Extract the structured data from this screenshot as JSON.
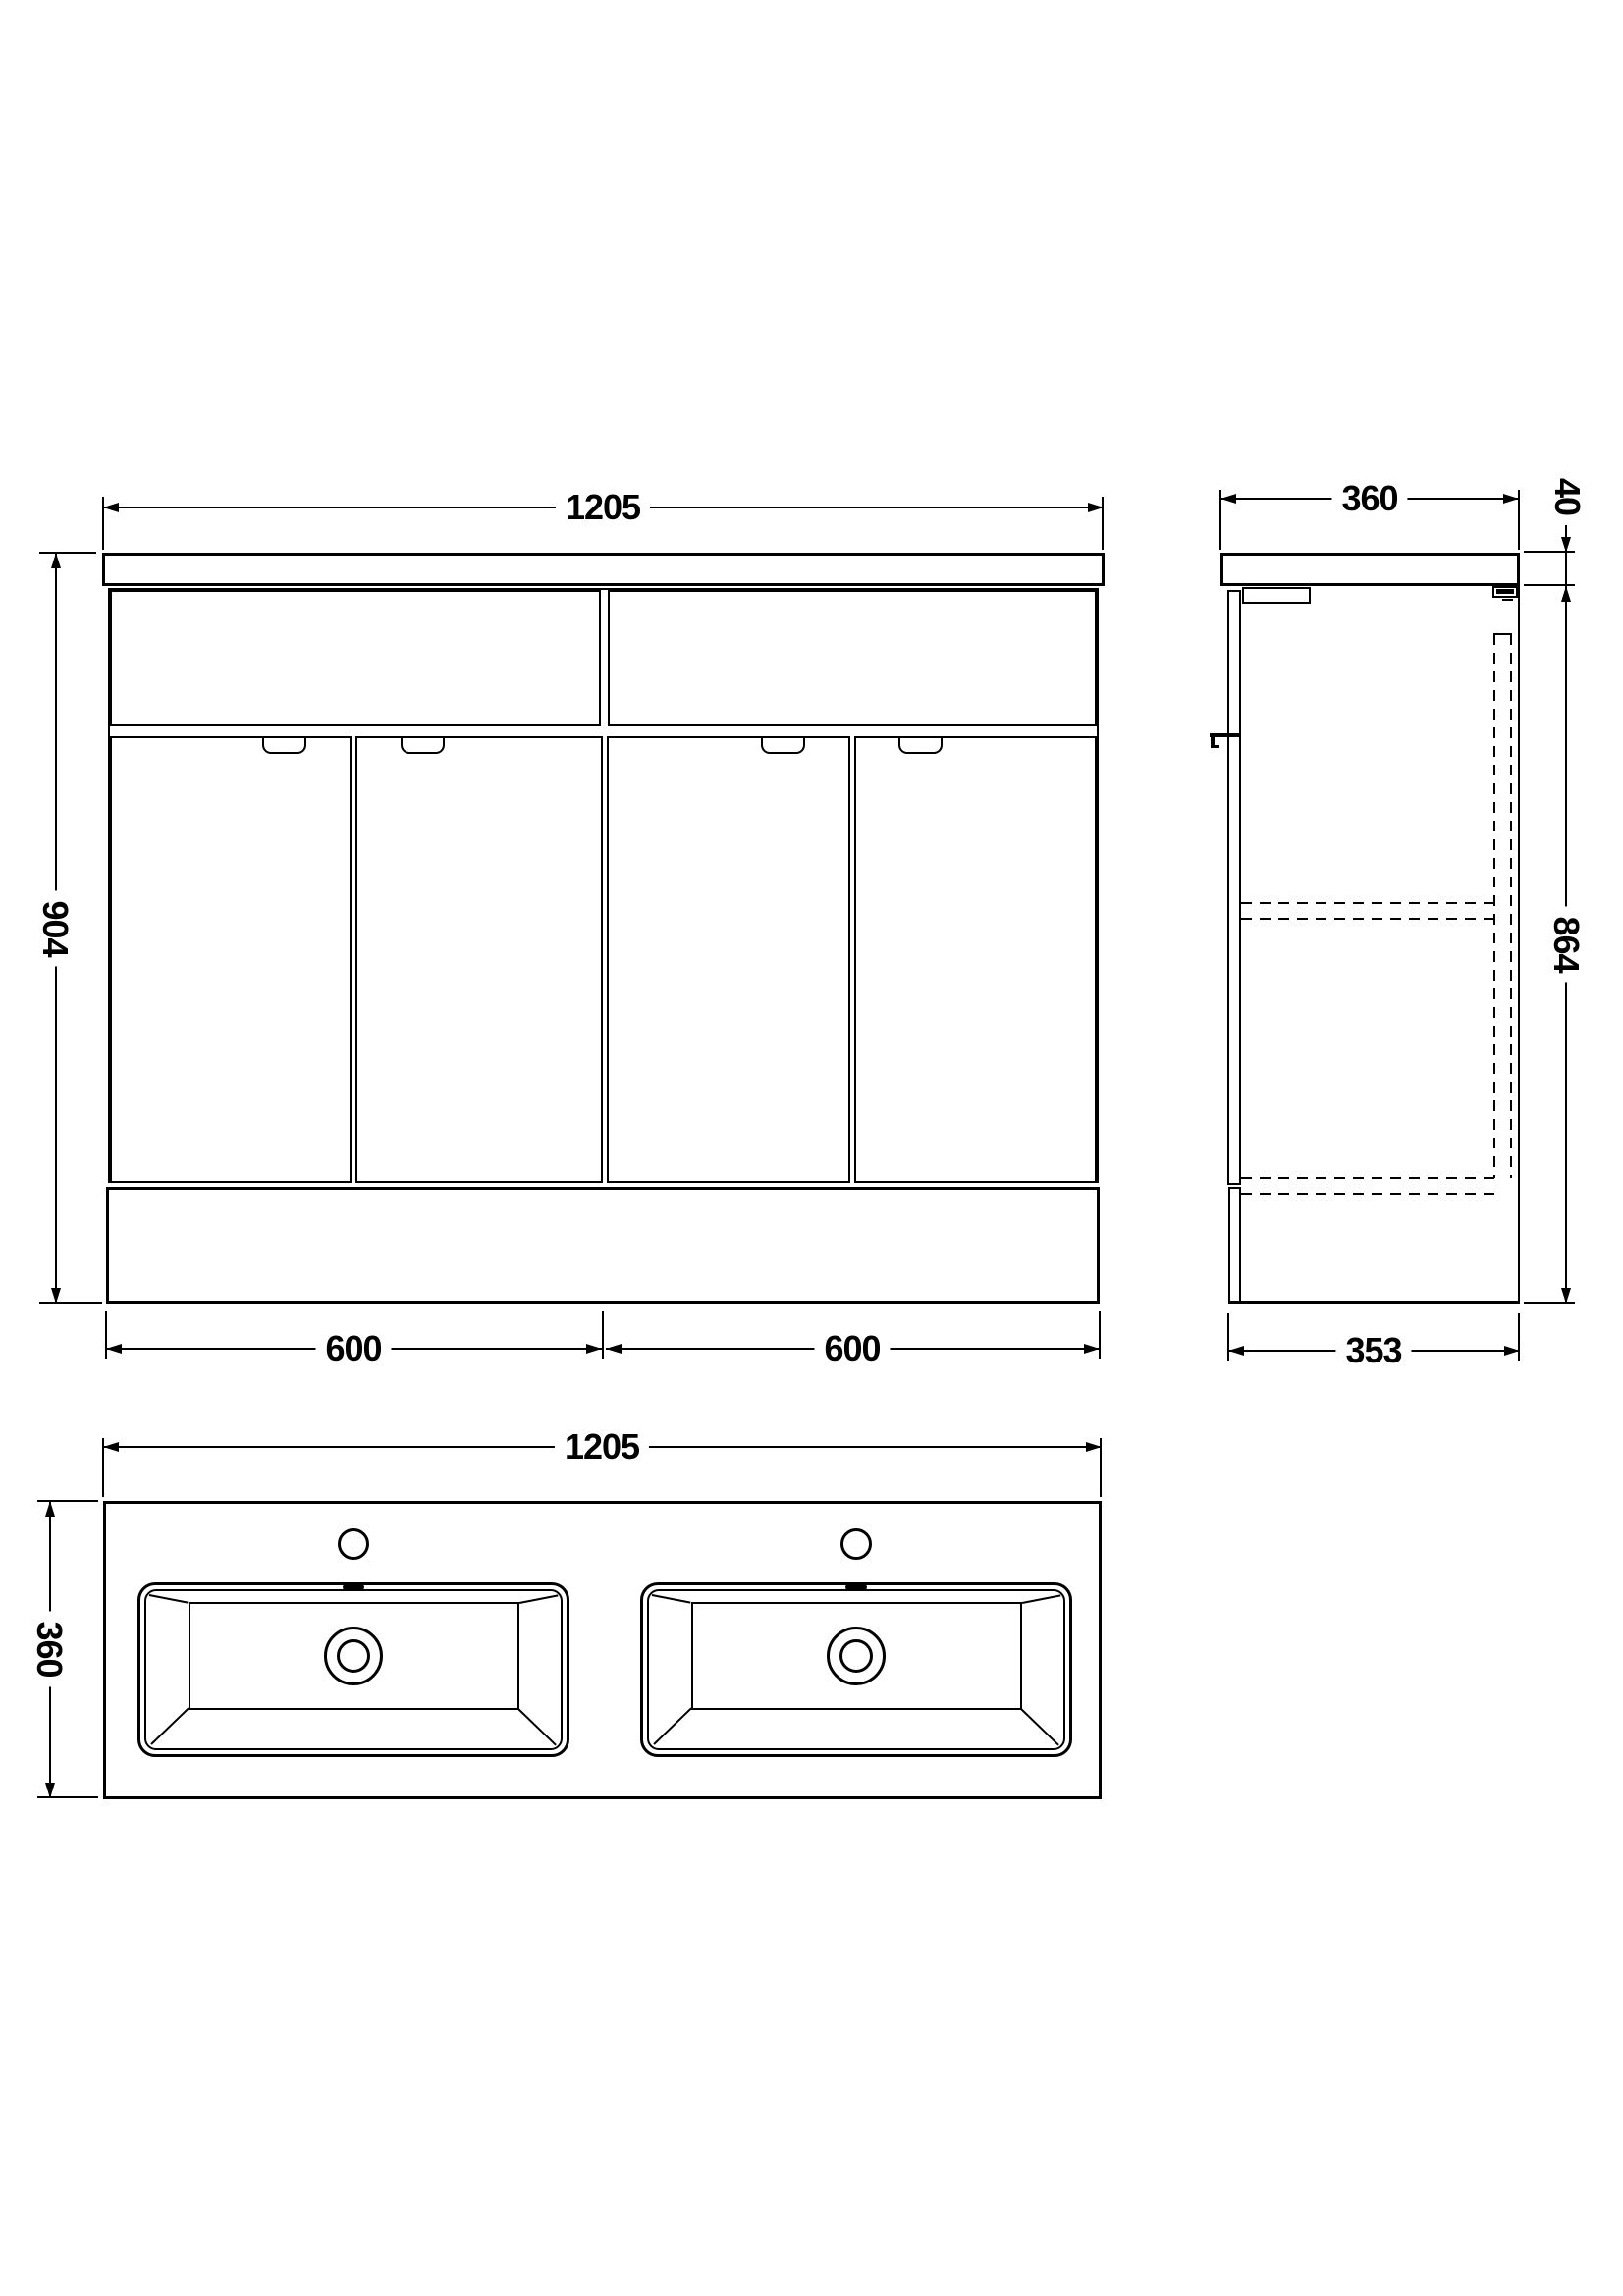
{
  "colors": {
    "line": "#000000",
    "background": "#ffffff"
  },
  "front_view": {
    "width_mm": "1205",
    "height_mm": "904",
    "left_section_mm": "600",
    "right_section_mm": "600"
  },
  "side_view": {
    "depth_mm": "360",
    "worktop_thickness_mm": "40",
    "cabinet_height_mm": "864",
    "base_depth_mm": "353"
  },
  "plan_view": {
    "width_mm": "1205",
    "depth_mm": "360"
  }
}
